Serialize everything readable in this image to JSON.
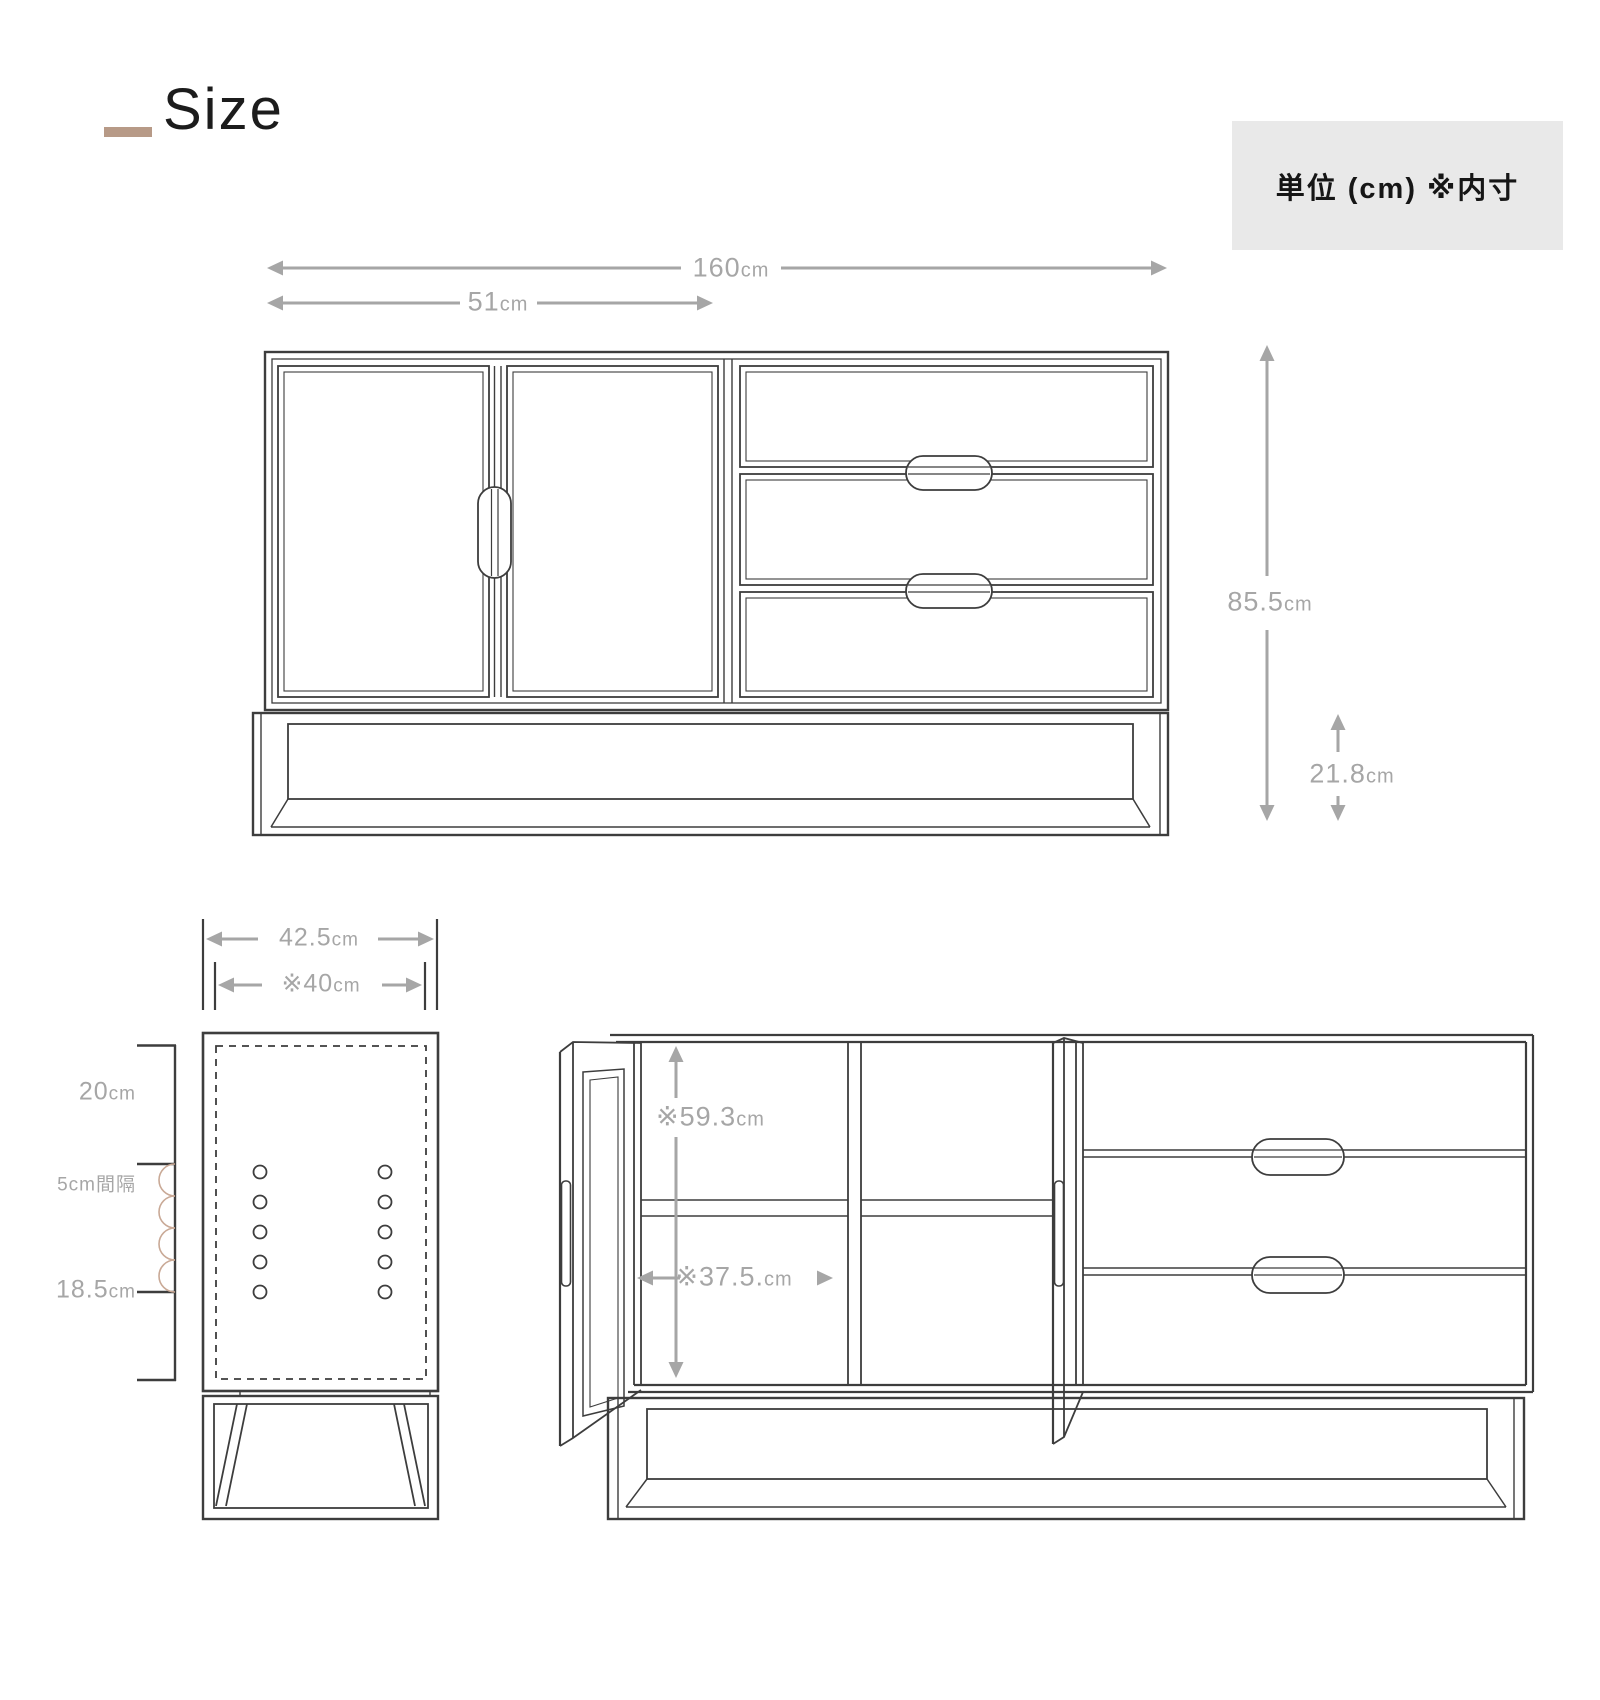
{
  "page": {
    "title": "Size",
    "unit_note": "単位 (cm) ※内寸"
  },
  "colors": {
    "line": "#3d3d3d",
    "dimension": "#a6a6a6",
    "accent_dash": "#b79a87",
    "interval_arc": "#c9a996",
    "note_box_bg": "#e9e9e9"
  },
  "front_view": {
    "total_width": {
      "value": "160",
      "unit": "cm"
    },
    "door_width": {
      "value": "51",
      "unit": "cm"
    },
    "total_height": {
      "value": "85.5",
      "unit": "cm"
    },
    "base_height": {
      "value": "21.8",
      "unit": "cm"
    }
  },
  "side_view": {
    "depth": {
      "value": "42.5",
      "unit": "cm"
    },
    "inner_depth": {
      "value": "※40",
      "unit": "cm"
    },
    "top_offset": {
      "value": "20",
      "unit": "cm"
    },
    "hole_pitch": {
      "text": "5cm間隔"
    },
    "bottom_offset": {
      "value": "18.5",
      "unit": "cm"
    }
  },
  "open_view": {
    "inner_height": {
      "value": "※59.3",
      "unit": "cm"
    },
    "inner_width": {
      "value": "※37.5.",
      "unit": "cm"
    }
  }
}
